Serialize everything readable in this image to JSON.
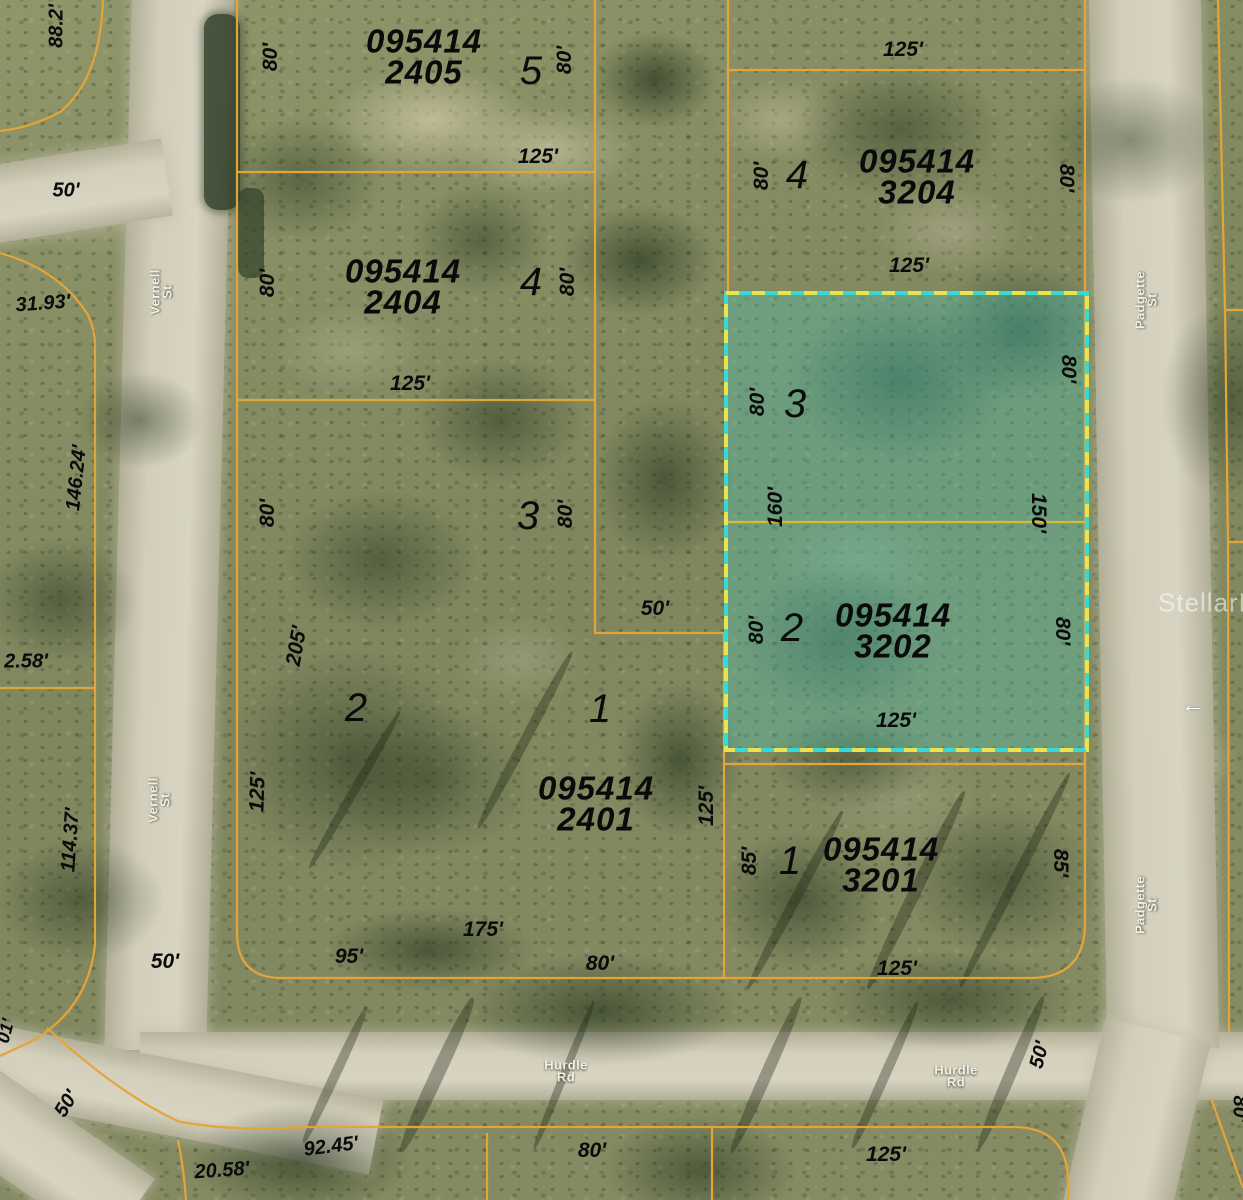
{
  "colors": {
    "parcel_line": "#E5A437",
    "highlight_border_cyan": "#35D9D5",
    "highlight_border_yellow": "#E8E34F",
    "highlight_fill": "rgba(70,200,185,0.33)",
    "label_color": "#0A0A0A",
    "street_label_color": "#F0F0E6"
  },
  "icons": {
    "pavement_arrow": "left-arrow"
  },
  "highlighted_parcel": {
    "id": "095414 3202",
    "lots": [
      "3",
      "2"
    ]
  },
  "labels": [
    {
      "n": "parcel-id-2405",
      "t": "095414\n2405",
      "x": 424,
      "y": 57,
      "r": 0,
      "k": "pid"
    },
    {
      "n": "parcel-id-2404",
      "t": "095414\n2404",
      "x": 403,
      "y": 287,
      "r": 0,
      "k": "pid"
    },
    {
      "n": "parcel-id-3204",
      "t": "095414\n3204",
      "x": 917,
      "y": 177,
      "r": 0,
      "k": "pid"
    },
    {
      "n": "parcel-id-3202",
      "t": "095414\n3202",
      "x": 893,
      "y": 631,
      "r": 0,
      "k": "pid"
    },
    {
      "n": "parcel-id-2401",
      "t": "095414\n2401",
      "x": 596,
      "y": 804,
      "r": 0,
      "k": "pid"
    },
    {
      "n": "parcel-id-3201",
      "t": "095414\n3201",
      "x": 881,
      "y": 865,
      "r": 0,
      "k": "pid"
    },
    {
      "n": "lot-number-5",
      "t": "5",
      "x": 531,
      "y": 71,
      "r": 0,
      "k": "lot"
    },
    {
      "n": "lot-number-4-left",
      "t": "4",
      "x": 531,
      "y": 282,
      "r": 0,
      "k": "lot"
    },
    {
      "n": "lot-number-4-right",
      "t": "4",
      "x": 797,
      "y": 175,
      "r": 0,
      "k": "lot"
    },
    {
      "n": "lot-number-3-left",
      "t": "3",
      "x": 528,
      "y": 516,
      "r": 0,
      "k": "lot"
    },
    {
      "n": "lot-number-3-highlight",
      "t": "3",
      "x": 795,
      "y": 404,
      "r": 0,
      "k": "lot"
    },
    {
      "n": "lot-number-2-left",
      "t": "2",
      "x": 356,
      "y": 708,
      "r": 0,
      "k": "lot"
    },
    {
      "n": "lot-number-2-highlight",
      "t": "2",
      "x": 792,
      "y": 628,
      "r": 0,
      "k": "lot"
    },
    {
      "n": "lot-number-1-left",
      "t": "1",
      "x": 600,
      "y": 709,
      "r": 0,
      "k": "lot"
    },
    {
      "n": "lot-number-1-right",
      "t": "1",
      "x": 790,
      "y": 861,
      "r": 0,
      "k": "lot"
    },
    {
      "n": "dim-2405-west",
      "t": "80'",
      "x": 271,
      "y": 57,
      "r": -90,
      "k": "dim"
    },
    {
      "n": "dim-2405-east",
      "t": "80'",
      "x": 565,
      "y": 60,
      "r": -90,
      "k": "dim"
    },
    {
      "n": "dim-2405-south",
      "t": "125'",
      "x": 538,
      "y": 157,
      "r": 0,
      "k": "dim"
    },
    {
      "n": "dim-2404-west",
      "t": "80'",
      "x": 268,
      "y": 283,
      "r": -90,
      "k": "dim"
    },
    {
      "n": "dim-2404-east",
      "t": "80'",
      "x": 568,
      "y": 282,
      "r": -90,
      "k": "dim"
    },
    {
      "n": "dim-2404-south",
      "t": "125'",
      "x": 410,
      "y": 384,
      "r": 0,
      "k": "dim"
    },
    {
      "n": "dim-lot3-west",
      "t": "80'",
      "x": 268,
      "y": 513,
      "r": -90,
      "k": "dim"
    },
    {
      "n": "dim-lot3-east",
      "t": "80'",
      "x": 566,
      "y": 514,
      "r": -90,
      "k": "dim"
    },
    {
      "n": "dim-notch",
      "t": "50'",
      "x": 655,
      "y": 609,
      "r": 0,
      "k": "dim"
    },
    {
      "n": "dim-2401-west-205",
      "t": "205'",
      "x": 297,
      "y": 646,
      "r": -80,
      "k": "dim"
    },
    {
      "n": "dim-2401-west-125",
      "t": "125'",
      "x": 258,
      "y": 792,
      "r": -88,
      "k": "dim"
    },
    {
      "n": "dim-2401-south-95",
      "t": "95'",
      "x": 349,
      "y": 957,
      "r": 0,
      "k": "dim"
    },
    {
      "n": "dim-2401-south-175",
      "t": "175'",
      "x": 483,
      "y": 930,
      "r": 0,
      "k": "dim"
    },
    {
      "n": "dim-2401-south-80",
      "t": "80'",
      "x": 600,
      "y": 964,
      "r": 0,
      "k": "dim"
    },
    {
      "n": "dim-2401-east-125",
      "t": "125'",
      "x": 707,
      "y": 806,
      "r": -90,
      "k": "dim"
    },
    {
      "n": "dim-3204-north",
      "t": "125'",
      "x": 903,
      "y": 50,
      "r": 0,
      "k": "dim"
    },
    {
      "n": "dim-3204-west",
      "t": "80'",
      "x": 762,
      "y": 176,
      "r": -90,
      "k": "dim"
    },
    {
      "n": "dim-3204-east",
      "t": "80'",
      "x": 1066,
      "y": 178,
      "r": 90,
      "k": "dim"
    },
    {
      "n": "dim-3204-south",
      "t": "125'",
      "x": 909,
      "y": 266,
      "r": 0,
      "k": "dim"
    },
    {
      "n": "dim-hl-lot3-west",
      "t": "80'",
      "x": 758,
      "y": 402,
      "r": -90,
      "k": "dim"
    },
    {
      "n": "dim-hl-lot3-east",
      "t": "80'",
      "x": 1068,
      "y": 369,
      "r": 90,
      "k": "dim"
    },
    {
      "n": "dim-hl-160",
      "t": "160'",
      "x": 776,
      "y": 507,
      "r": -90,
      "k": "dim"
    },
    {
      "n": "dim-hl-150",
      "t": "150'",
      "x": 1038,
      "y": 513,
      "r": 90,
      "k": "dim"
    },
    {
      "n": "dim-hl-lot2-west",
      "t": "80'",
      "x": 757,
      "y": 630,
      "r": -90,
      "k": "dim"
    },
    {
      "n": "dim-hl-lot2-east",
      "t": "80'",
      "x": 1062,
      "y": 631,
      "r": 90,
      "k": "dim"
    },
    {
      "n": "dim-hl-south",
      "t": "125'",
      "x": 896,
      "y": 721,
      "r": 0,
      "k": "dim"
    },
    {
      "n": "dim-3201-west",
      "t": "85'",
      "x": 750,
      "y": 861,
      "r": -90,
      "k": "dim"
    },
    {
      "n": "dim-3201-east",
      "t": "85'",
      "x": 1060,
      "y": 863,
      "r": 90,
      "k": "dim"
    },
    {
      "n": "dim-3201-south",
      "t": "125'",
      "x": 897,
      "y": 969,
      "r": 0,
      "k": "dim"
    },
    {
      "n": "dim-edge-88",
      "t": "88.2'",
      "x": 57,
      "y": 26,
      "r": -90,
      "k": "dim",
      "fs": 20
    },
    {
      "n": "dim-edge-50-top",
      "t": "50'",
      "x": 66,
      "y": 191,
      "r": 0,
      "k": "dim",
      "fs": 20
    },
    {
      "n": "dim-edge-3193",
      "t": "31.93'",
      "x": 43,
      "y": 304,
      "r": -4,
      "k": "dim",
      "fs": 20
    },
    {
      "n": "dim-edge-14624",
      "t": "146.24'",
      "x": 77,
      "y": 478,
      "r": -84,
      "k": "dim",
      "fs": 20
    },
    {
      "n": "dim-edge-258",
      "t": "2.58'",
      "x": 26,
      "y": 662,
      "r": 0,
      "k": "dim",
      "fs": 20
    },
    {
      "n": "dim-edge-11437",
      "t": "114.37'",
      "x": 71,
      "y": 840,
      "r": -86,
      "k": "dim",
      "fs": 20
    },
    {
      "n": "dim-vernell-50",
      "t": "50'",
      "x": 165,
      "y": 962,
      "r": 0,
      "k": "dim"
    },
    {
      "n": "dim-edge-01",
      "t": "01'",
      "x": 6,
      "y": 1031,
      "r": -75,
      "k": "dim",
      "fs": 18
    },
    {
      "n": "dim-sw-50",
      "t": "50'",
      "x": 67,
      "y": 1104,
      "r": -58,
      "k": "dim",
      "fs": 20
    },
    {
      "n": "dim-strip-9245",
      "t": "92.45'",
      "x": 331,
      "y": 1147,
      "r": -7,
      "k": "dim",
      "fs": 20
    },
    {
      "n": "dim-strip-2058",
      "t": "20.58'",
      "x": 222,
      "y": 1171,
      "r": -4,
      "k": "dim",
      "fs": 20
    },
    {
      "n": "dim-strip-80",
      "t": "80'",
      "x": 592,
      "y": 1151,
      "r": 0,
      "k": "dim"
    },
    {
      "n": "dim-strip-125",
      "t": "125'",
      "x": 886,
      "y": 1155,
      "r": 0,
      "k": "dim"
    },
    {
      "n": "dim-strip-80-right",
      "t": "80'",
      "x": 1239,
      "y": 1109,
      "r": 90,
      "k": "dim",
      "fs": 20
    },
    {
      "n": "dim-padgette-50",
      "t": "50'",
      "x": 1040,
      "y": 1055,
      "r": -75,
      "k": "dim",
      "fs": 20
    },
    {
      "n": "street-vernell-st-north",
      "t": "Vernell St",
      "x": 162,
      "y": 292,
      "r": -90,
      "k": "street"
    },
    {
      "n": "street-vernell-st-south",
      "t": "Vernell St",
      "x": 160,
      "y": 800,
      "r": -90,
      "k": "street"
    },
    {
      "n": "street-padgette-st-north",
      "t": "Padgette St",
      "x": 1147,
      "y": 300,
      "r": -90,
      "k": "street"
    },
    {
      "n": "street-padgette-st-south",
      "t": "Padgette St",
      "x": 1147,
      "y": 905,
      "r": -90,
      "k": "street"
    },
    {
      "n": "street-hurdle-rd-west",
      "t": "Hurdle Rd",
      "x": 566,
      "y": 1072,
      "r": 0,
      "k": "street"
    },
    {
      "n": "street-hurdle-rd-east",
      "t": "Hurdle Rd",
      "x": 956,
      "y": 1077,
      "r": 0,
      "k": "street"
    },
    {
      "n": "pavement-arrow-icon",
      "t": "←",
      "x": 1193,
      "y": 706,
      "r": 0,
      "k": "icon"
    },
    {
      "n": "watermark-stellar-mls",
      "t": "StellarMLS",
      "x": 1158,
      "y": 603,
      "r": 0,
      "k": "wm",
      "a": "left"
    }
  ]
}
